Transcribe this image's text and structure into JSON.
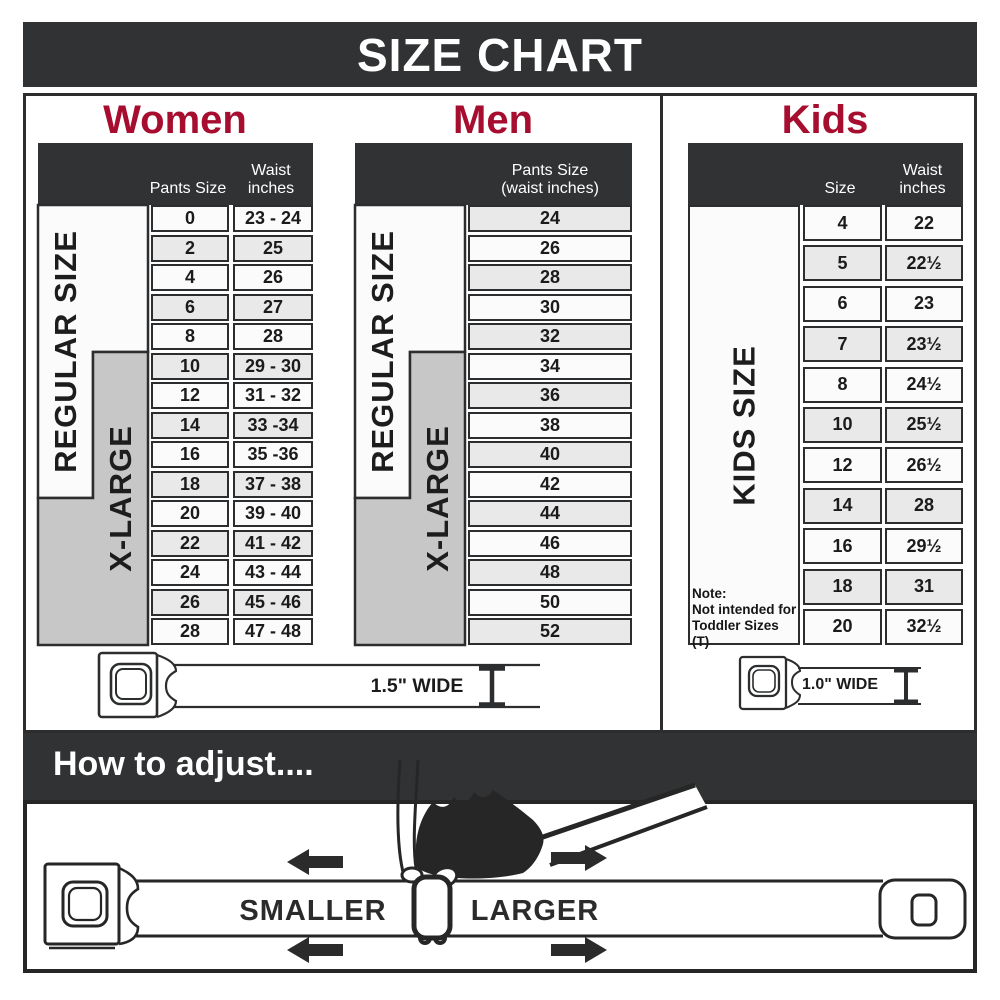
{
  "banner": {
    "title": "SIZE CHART"
  },
  "women": {
    "title": "Women",
    "col1_header": "Pants Size",
    "col2_header_line1": "Waist",
    "col2_header_line2": "inches",
    "regular_label": "REGULAR SIZE",
    "xlarge_label": "X-LARGE",
    "rows": [
      {
        "size": "0",
        "waist": "23 - 24"
      },
      {
        "size": "2",
        "waist": "25"
      },
      {
        "size": "4",
        "waist": "26"
      },
      {
        "size": "6",
        "waist": "27"
      },
      {
        "size": "8",
        "waist": "28"
      },
      {
        "size": "10",
        "waist": "29 - 30"
      },
      {
        "size": "12",
        "waist": "31 - 32"
      },
      {
        "size": "14",
        "waist": "33 -34"
      },
      {
        "size": "16",
        "waist": "35 -36"
      },
      {
        "size": "18",
        "waist": "37 - 38"
      },
      {
        "size": "20",
        "waist": "39 - 40"
      },
      {
        "size": "22",
        "waist": "41 - 42"
      },
      {
        "size": "24",
        "waist": "43 - 44"
      },
      {
        "size": "26",
        "waist": "45 - 46"
      },
      {
        "size": "28",
        "waist": "47 - 48"
      }
    ]
  },
  "men": {
    "title": "Men",
    "col_header_line1": "Pants Size",
    "col_header_line2": "(waist inches)",
    "regular_label": "REGULAR SIZE",
    "xlarge_label": "X-LARGE",
    "rows": [
      {
        "size": "24"
      },
      {
        "size": "26"
      },
      {
        "size": "28"
      },
      {
        "size": "30"
      },
      {
        "size": "32"
      },
      {
        "size": "34"
      },
      {
        "size": "36"
      },
      {
        "size": "38"
      },
      {
        "size": "40"
      },
      {
        "size": "42"
      },
      {
        "size": "44"
      },
      {
        "size": "46"
      },
      {
        "size": "48"
      },
      {
        "size": "50"
      },
      {
        "size": "52"
      }
    ]
  },
  "kids": {
    "title": "Kids",
    "col1_header": "Size",
    "col2_header_line1": "Waist",
    "col2_header_line2": "inches",
    "kids_label": "KIDS SIZE",
    "note_line1": "Note:",
    "note_line2": "Not intended for",
    "note_line3": "Toddler Sizes (T)",
    "rows": [
      {
        "size": "4",
        "waist": "22"
      },
      {
        "size": "5",
        "waist": "22½"
      },
      {
        "size": "6",
        "waist": "23"
      },
      {
        "size": "7",
        "waist": "23½"
      },
      {
        "size": "8",
        "waist": "24½"
      },
      {
        "size": "10",
        "waist": "25½"
      },
      {
        "size": "12",
        "waist": "26½"
      },
      {
        "size": "14",
        "waist": "28"
      },
      {
        "size": "16",
        "waist": "29½"
      },
      {
        "size": "18",
        "waist": "31"
      },
      {
        "size": "20",
        "waist": "32½"
      }
    ]
  },
  "belts": {
    "adult_width_label": "1.5\" WIDE",
    "kids_width_label": "1.0\" WIDE"
  },
  "adjust": {
    "heading": "How to adjust....",
    "smaller": "SMALLER",
    "larger": "LARGER"
  },
  "colors": {
    "dark": "#303233",
    "red": "#A60D2F",
    "gray_xl": "#C7C7C7",
    "row_alt": "#E9E9E9",
    "line": "#2B2D2E"
  }
}
